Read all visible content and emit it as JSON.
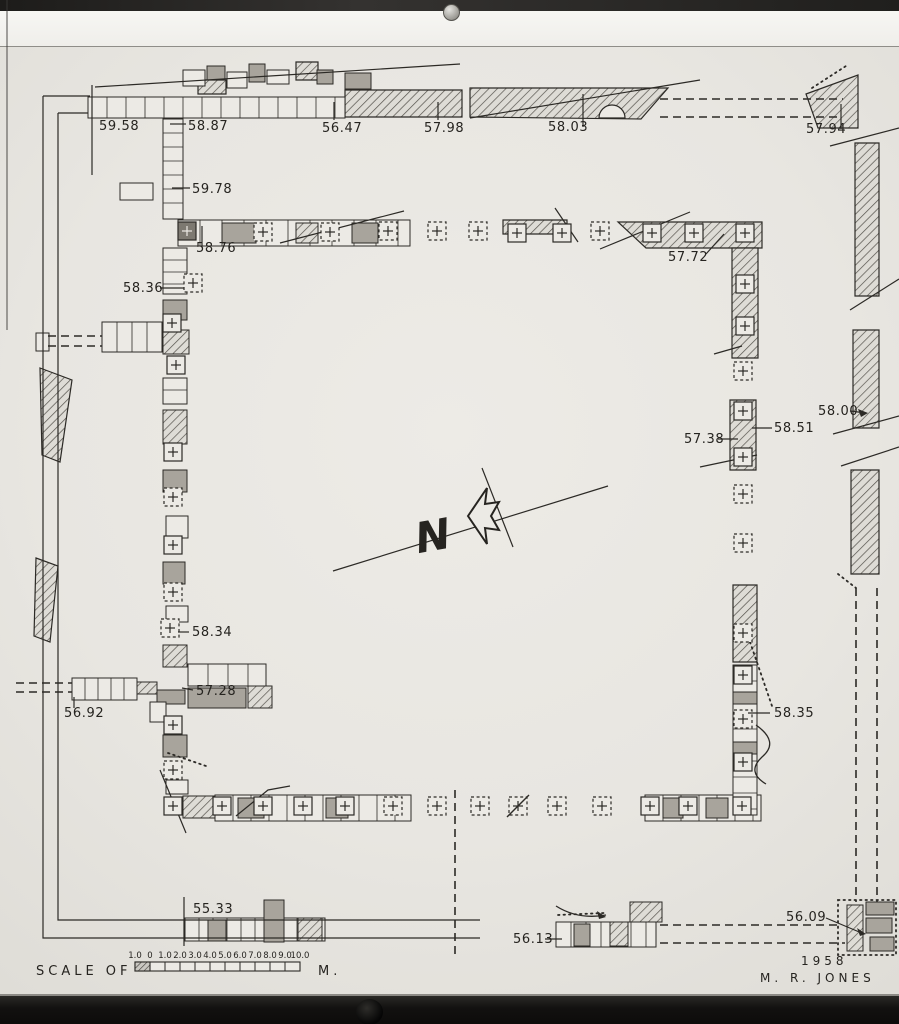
{
  "title_block": {
    "year": "1958",
    "author": "M. R. JONES"
  },
  "scale": {
    "label": "SCALE OF",
    "unit": "M.",
    "x": 135,
    "y": 962,
    "seg": 15,
    "h": 9,
    "ticks": [
      "1.0",
      "0",
      "1.0",
      "2.0",
      "3.0",
      "4.0",
      "5.0",
      "6.0",
      "7.0",
      "8.0",
      "9.0",
      "10.0"
    ]
  },
  "north": {
    "label": "N"
  },
  "elevations": [
    {
      "v": "59.58",
      "x": 99,
      "y": 130,
      "l": [
        92,
        85,
        92,
        175
      ]
    },
    {
      "v": "58.87",
      "x": 188,
      "y": 130,
      "l": [
        170,
        124,
        186,
        124
      ]
    },
    {
      "v": "56.47",
      "x": 322,
      "y": 132,
      "l": [
        334,
        102,
        334,
        120
      ]
    },
    {
      "v": "57.98",
      "x": 424,
      "y": 132,
      "l": [
        438,
        102,
        438,
        120
      ]
    },
    {
      "v": "58.03",
      "x": 548,
      "y": 131,
      "l": [
        583,
        94,
        583,
        127
      ]
    },
    {
      "v": "57.94",
      "x": 806,
      "y": 133,
      "l": [
        841,
        104,
        841,
        129
      ]
    },
    {
      "v": "59.78",
      "x": 192,
      "y": 193,
      "l": [
        172,
        188,
        190,
        188
      ]
    },
    {
      "v": "58.76",
      "x": 196,
      "y": 252,
      "l": [
        202,
        226,
        202,
        246
      ]
    },
    {
      "v": "58.36",
      "x": 123,
      "y": 292,
      "l": [
        160,
        288,
        184,
        288
      ]
    },
    {
      "v": "57.72",
      "x": 668,
      "y": 261,
      "l": [
        706,
        254,
        724,
        234
      ]
    },
    {
      "v": "58.00",
      "x": 818,
      "y": 415,
      "l": [
        850,
        411,
        866,
        413
      ]
    },
    {
      "v": "58.51",
      "x": 774,
      "y": 432,
      "l": [
        772,
        428,
        752,
        428
      ]
    },
    {
      "v": "57.38",
      "x": 684,
      "y": 443,
      "l": [
        718,
        439,
        738,
        439
      ]
    },
    {
      "v": "58.34",
      "x": 192,
      "y": 636,
      "l": [
        178,
        632,
        189,
        632
      ]
    },
    {
      "v": "57.28",
      "x": 196,
      "y": 695,
      "l": [
        182,
        688,
        193,
        690
      ]
    },
    {
      "v": "56.92",
      "x": 64,
      "y": 717,
      "l": [
        74,
        697,
        74,
        708
      ]
    },
    {
      "v": "58.35",
      "x": 774,
      "y": 717,
      "l": [
        748,
        713,
        770,
        713
      ]
    },
    {
      "v": "55.33",
      "x": 193,
      "y": 913,
      "l": [
        184,
        897,
        184,
        946
      ]
    },
    {
      "v": "56.13",
      "x": 513,
      "y": 943,
      "l": [
        545,
        939,
        562,
        939
      ]
    },
    {
      "v": "56.09",
      "x": 786,
      "y": 921,
      "l": [
        826,
        918,
        864,
        934
      ]
    }
  ],
  "plan": {
    "hatched": [
      "470,88 668,88 641,119 470,117",
      "345,90 462,90 462,117 345,117",
      "806,94 858,75 858,128 818,128",
      "855,143 879,143 879,296 855,296",
      "853,330 879,330 879,428 853,428",
      "851,470 879,470 879,574 851,574",
      "618,222 762,222 762,248 646,248",
      "732,248 758,248 758,358 732,358",
      "730,400 756,400 756,470 730,470",
      "733,585 757,585 757,662 733,662",
      "503,220 567,220 567,234 503,234",
      "40,368 72,380 60,462 42,455",
      "36,558 58,566 50,642 34,636",
      "198,80 226,80 226,94 198,94",
      "296,62 318,62 318,80 296,80"
    ],
    "blocks": [
      [
        88,
        97,
        257,
        21,
        "p",
        19
      ],
      [
        183,
        70,
        22,
        16,
        "p",
        0
      ],
      [
        207,
        66,
        18,
        14,
        "g",
        0
      ],
      [
        227,
        72,
        20,
        16,
        "p",
        0
      ],
      [
        249,
        64,
        16,
        18,
        "g",
        0
      ],
      [
        267,
        70,
        22,
        14,
        "p",
        0
      ],
      [
        317,
        70,
        16,
        14,
        "g",
        0
      ],
      [
        345,
        73,
        26,
        16,
        "g",
        0
      ],
      [
        163,
        119,
        20,
        100,
        "p",
        14
      ],
      [
        120,
        183,
        33,
        17,
        "p",
        0
      ],
      [
        178,
        220,
        232,
        26,
        "p",
        22
      ],
      [
        222,
        223,
        34,
        20,
        "g",
        0
      ],
      [
        352,
        223,
        26,
        20,
        "g",
        0
      ],
      [
        296,
        223,
        22,
        20,
        "h",
        0
      ],
      [
        163,
        248,
        24,
        46,
        "p",
        12
      ],
      [
        163,
        300,
        24,
        20,
        "g",
        0
      ],
      [
        102,
        322,
        60,
        30,
        "p",
        15
      ],
      [
        36,
        333,
        13,
        18,
        "p",
        0
      ],
      [
        163,
        330,
        26,
        24,
        "h",
        0
      ],
      [
        163,
        378,
        24,
        26,
        "p",
        12
      ],
      [
        163,
        410,
        24,
        34,
        "h",
        0
      ],
      [
        163,
        470,
        24,
        22,
        "g",
        0
      ],
      [
        166,
        516,
        22,
        22,
        "p",
        0
      ],
      [
        163,
        562,
        22,
        22,
        "g",
        0
      ],
      [
        166,
        606,
        22,
        16,
        "p",
        0
      ],
      [
        163,
        645,
        24,
        22,
        "h",
        0
      ],
      [
        72,
        678,
        65,
        22,
        "p",
        13
      ],
      [
        137,
        682,
        20,
        12,
        "h",
        0
      ],
      [
        157,
        690,
        28,
        14,
        "g",
        0
      ],
      [
        188,
        664,
        78,
        22,
        "p",
        20
      ],
      [
        188,
        688,
        58,
        20,
        "g",
        0
      ],
      [
        248,
        686,
        24,
        22,
        "h",
        0
      ],
      [
        150,
        702,
        16,
        20,
        "p",
        0
      ],
      [
        163,
        735,
        24,
        22,
        "g",
        0
      ],
      [
        166,
        780,
        22,
        14,
        "p",
        0
      ],
      [
        183,
        796,
        32,
        22,
        "h",
        0
      ],
      [
        215,
        795,
        196,
        26,
        "p",
        18
      ],
      [
        238,
        798,
        26,
        20,
        "g",
        0
      ],
      [
        326,
        798,
        22,
        20,
        "g",
        0
      ],
      [
        645,
        795,
        116,
        26,
        "p",
        18
      ],
      [
        663,
        798,
        20,
        20,
        "g",
        0
      ],
      [
        706,
        798,
        22,
        20,
        "g",
        0
      ],
      [
        733,
        665,
        24,
        150,
        "p",
        16
      ],
      [
        733,
        692,
        24,
        12,
        "g",
        0
      ],
      [
        733,
        742,
        24,
        12,
        "g",
        0
      ],
      [
        185,
        918,
        140,
        23,
        "p",
        14
      ],
      [
        264,
        900,
        20,
        42,
        "g",
        0
      ],
      [
        208,
        920,
        18,
        21,
        "g",
        0
      ],
      [
        298,
        918,
        24,
        23,
        "h",
        0
      ],
      [
        556,
        922,
        100,
        25,
        "p",
        15
      ],
      [
        574,
        924,
        16,
        22,
        "g",
        0
      ],
      [
        610,
        922,
        18,
        24,
        "h",
        0
      ],
      [
        630,
        902,
        32,
        20,
        "h",
        0
      ],
      [
        847,
        905,
        16,
        46,
        "h",
        0
      ],
      [
        866,
        902,
        28,
        13,
        "g",
        0
      ],
      [
        866,
        918,
        26,
        15,
        "g",
        0
      ],
      [
        870,
        937,
        24,
        14,
        "g",
        0
      ]
    ],
    "piers": [
      [
        187,
        231,
        "k"
      ],
      [
        263,
        232,
        "d"
      ],
      [
        330,
        232,
        "d"
      ],
      [
        388,
        231,
        "d"
      ],
      [
        437,
        231,
        "d"
      ],
      [
        478,
        231,
        "d"
      ],
      [
        517,
        233,
        "s"
      ],
      [
        562,
        233,
        "s"
      ],
      [
        600,
        231,
        "d"
      ],
      [
        652,
        233,
        "s"
      ],
      [
        694,
        233,
        "s"
      ],
      [
        745,
        233,
        "s"
      ],
      [
        745,
        284,
        "s"
      ],
      [
        745,
        326,
        "s"
      ],
      [
        743,
        371,
        "d"
      ],
      [
        743,
        411,
        "s"
      ],
      [
        743,
        457,
        "s"
      ],
      [
        743,
        494,
        "d"
      ],
      [
        743,
        543,
        "d"
      ],
      [
        743,
        633,
        "d"
      ],
      [
        743,
        675,
        "s"
      ],
      [
        743,
        719,
        "d"
      ],
      [
        743,
        762,
        "s"
      ],
      [
        742,
        806,
        "s"
      ],
      [
        688,
        806,
        "s"
      ],
      [
        650,
        806,
        "s"
      ],
      [
        602,
        806,
        "d"
      ],
      [
        557,
        806,
        "d"
      ],
      [
        518,
        806,
        "x"
      ],
      [
        480,
        806,
        "d"
      ],
      [
        437,
        806,
        "d"
      ],
      [
        393,
        806,
        "d"
      ],
      [
        345,
        806,
        "s"
      ],
      [
        303,
        806,
        "s"
      ],
      [
        263,
        806,
        "s"
      ],
      [
        222,
        806,
        "s"
      ],
      [
        173,
        806,
        "s"
      ],
      [
        193,
        283,
        "d"
      ],
      [
        172,
        323,
        "s"
      ],
      [
        176,
        365,
        "s"
      ],
      [
        173,
        452,
        "s"
      ],
      [
        173,
        497,
        "d"
      ],
      [
        173,
        545,
        "s"
      ],
      [
        173,
        592,
        "d"
      ],
      [
        170,
        628,
        "d"
      ],
      [
        173,
        725,
        "s"
      ],
      [
        173,
        770,
        "d"
      ]
    ],
    "solid": [
      "43,96 43,938 480,938",
      "43,96 90,96",
      "58,113 58,920 480,920",
      "58,113 88,113",
      "95,87 460,64",
      "470,118 700,80",
      "280,243 404,211",
      "600,249 690,212",
      "555,208 578,242",
      "850,310 899,279",
      "833,434 899,416",
      "841,466 899,447",
      "333,571 608,486",
      "482,468 513,547",
      "160,770 186,833",
      "236,816 268,790 290,786",
      "714,354 742,346",
      "700,467 757,455",
      "830,146 899,128"
    ],
    "dashed": [
      "660,99 843,99",
      "660,117 838,117",
      "856,588 856,902",
      "877,588 877,902",
      "48,336 102,336",
      "48,346 102,346",
      "16,683 72,683",
      "16,692 72,692",
      "660,925 838,925",
      "660,943 845,943",
      "455,790 455,958"
    ],
    "dotted": [
      "812,88 846,66",
      "168,753 206,766",
      "750,642 772,706",
      "838,574 856,588",
      "558,915 604,913"
    ],
    "dotted_rects": [
      [
        838,
        900,
        58,
        55
      ]
    ],
    "curves": [
      "M756,725 Q780,742 762,757 Q746,772 766,784",
      "M556,906 Q578,920 606,915"
    ],
    "notch": "M599,118 A13 13 0 0 1 625,118 Z",
    "arrow": "M468,516 L487,488 L485,504 L499,502 L491,516 L499,530 L485,528 L487,544 Z",
    "arrowheads": [
      "868,413 858,409 861,417",
      "606,917 597,911 599,919",
      "866,934 857,928 860,936"
    ]
  }
}
